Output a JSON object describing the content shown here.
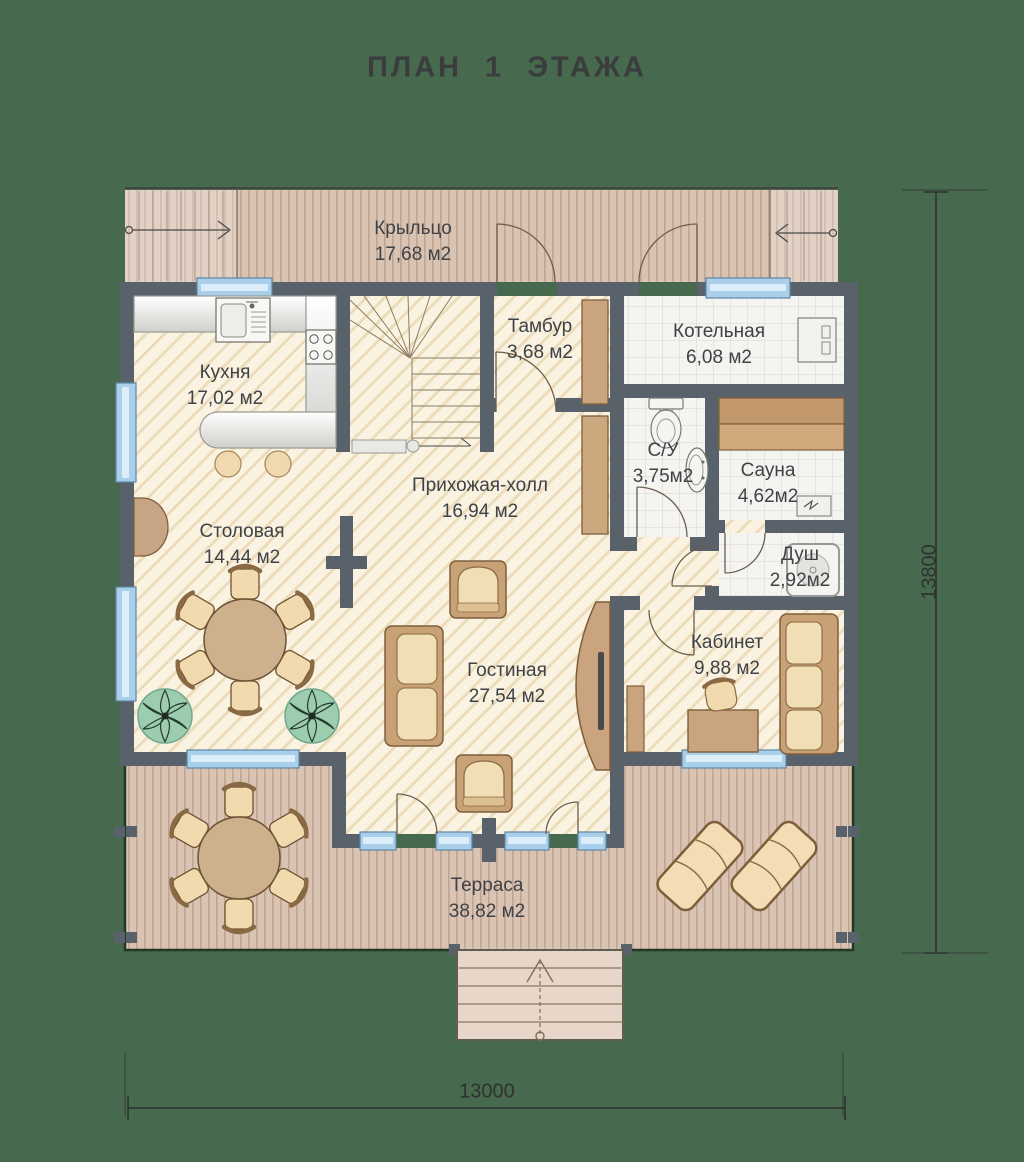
{
  "title": "ПЛАН 1 ЭТАЖА",
  "rooms": {
    "porch": {
      "name": "Крыльцо",
      "area": "17,68 м2"
    },
    "kitchen": {
      "name": "Кухня",
      "area": "17,02 м2"
    },
    "tambour": {
      "name": "Тамбур",
      "area": "3,68 м2"
    },
    "boiler": {
      "name": "Котельная",
      "area": "6,08 м2"
    },
    "wc": {
      "name": "С/У",
      "area": "3,75м2"
    },
    "sauna": {
      "name": "Сауна",
      "area": "4,62м2"
    },
    "shower": {
      "name": "Душ",
      "area": "2,92м2"
    },
    "hall": {
      "name": "Прихожая-холл",
      "area": "16,94 м2"
    },
    "dining": {
      "name": "Столовая",
      "area": "14,44 м2"
    },
    "living": {
      "name": "Гостиная",
      "area": "27,54 м2"
    },
    "office": {
      "name": "Кабинет",
      "area": "9,88 м2"
    },
    "terrace": {
      "name": "Терраса",
      "area": "38,82 м2"
    }
  },
  "dimensions": {
    "bottom_label": "13000",
    "right_label": "13800"
  },
  "colors": {
    "background": "#47694E",
    "walls": "#59616A",
    "window": "#A9CFEA",
    "floor_hatch": "#FBF3E2",
    "deck": "#D9C3B3",
    "tile": "#F4F4F1",
    "wood_furniture": "#C9A176",
    "cushion": "#F1DEB4",
    "label_text": "#3F4246"
  }
}
